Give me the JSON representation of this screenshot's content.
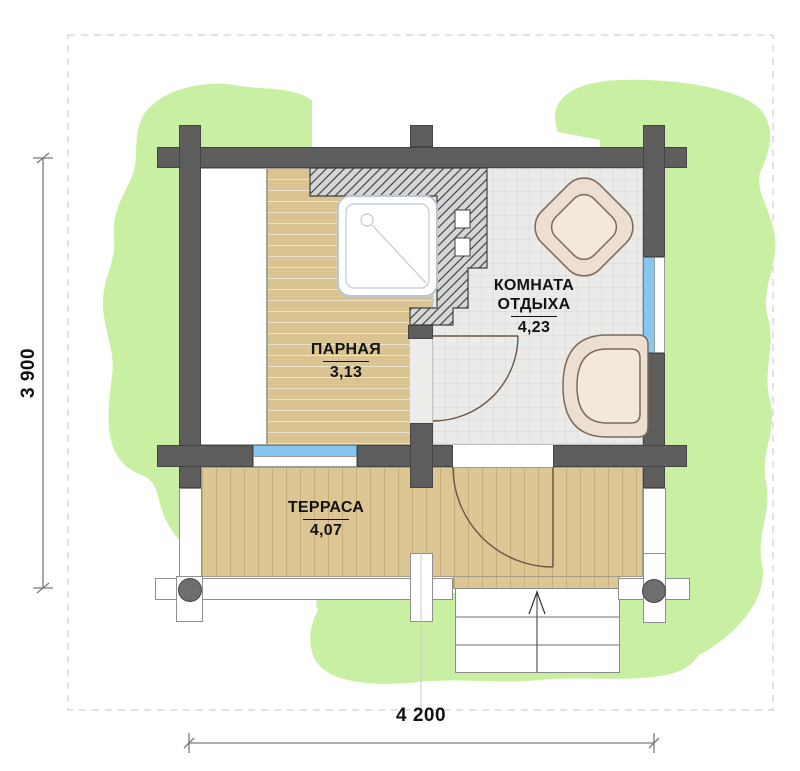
{
  "plan": {
    "type": "sauna floor plan",
    "rooms": {
      "parnaya": {
        "name": "ПАРНАЯ",
        "area": "3,13"
      },
      "otdyha": {
        "line1": "КОМНАТА",
        "line2": "ОТДЫХА",
        "area": "4,23"
      },
      "terrasa": {
        "name": "ТЕРРАСА",
        "area": "4,07"
      }
    },
    "dimensions": {
      "horizontal": "4 200",
      "vertical": "3 900"
    },
    "colors": {
      "wall": "#5d5d5d",
      "wood_floor": "#dcc693",
      "tile_floor": "#eaeae8",
      "window_glass": "#85c7f1",
      "greenery": "#c9f0a2",
      "furniture": "#ecdfd1",
      "stove_hatch": "#d6d6d6"
    }
  }
}
